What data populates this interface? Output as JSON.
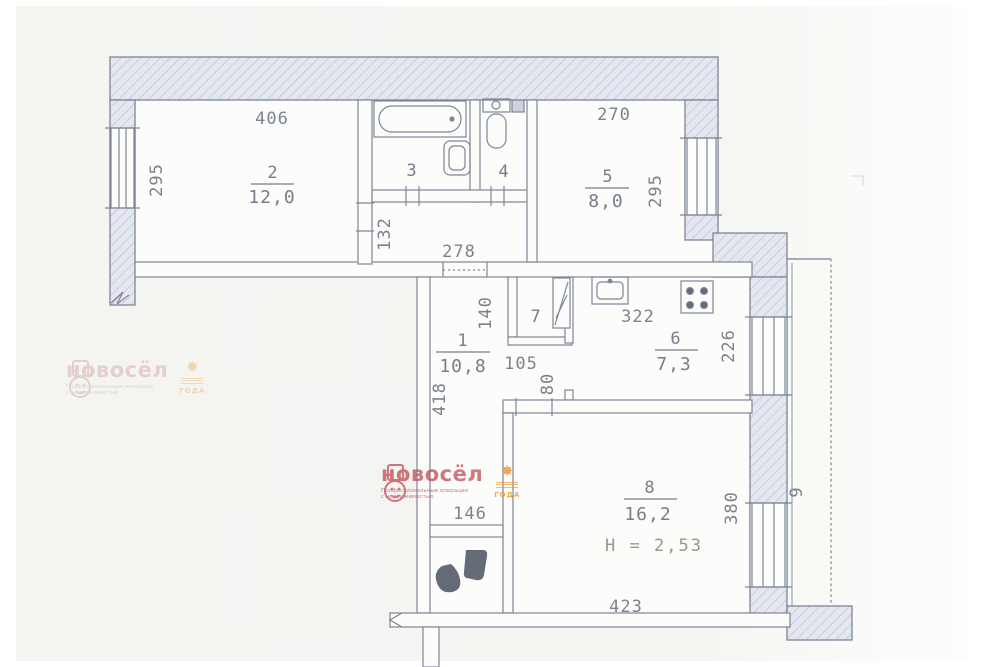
{
  "labels": {
    "r1_num": "1",
    "r1_area": "10,8",
    "r2_num": "2",
    "r2_area": "12,0",
    "r3_num": "3",
    "r4_num": "4",
    "r5_num": "5",
    "r5_area": "8,0",
    "r6_num": "6",
    "r6_area": "7,3",
    "r7_num": "7",
    "r8_num": "8",
    "r8_area": "16,2",
    "r8_height": "H = 2,53",
    "r9_num": "9"
  },
  "dims": {
    "room2_width": "406",
    "room2_depth": "295",
    "room5_width": "270",
    "room5_depth": "295",
    "corridor_depth": "132",
    "corridor_width": "278",
    "closet_depth": "140",
    "closet_width": "105",
    "kitchen_width": "322",
    "kitchen_depth": "226",
    "hall_depth": "418",
    "door_width": "80",
    "wc_width": "146",
    "room8_width": "423",
    "room8_depth": "380"
  },
  "watermark": {
    "brand": "новосёл",
    "tagline_line1": "Профессиональные операции",
    "tagline_line2": "с недвижимостью",
    "badge": "ГОДА",
    "star": "✸"
  },
  "colors": {
    "plan_line": "#7d8698",
    "plan_text": "#7b828f",
    "wall_fill": "#e4e7f0",
    "watermark_red": "#c4565e",
    "star_orange": "#e8962e",
    "background": "#f5f5f2"
  }
}
